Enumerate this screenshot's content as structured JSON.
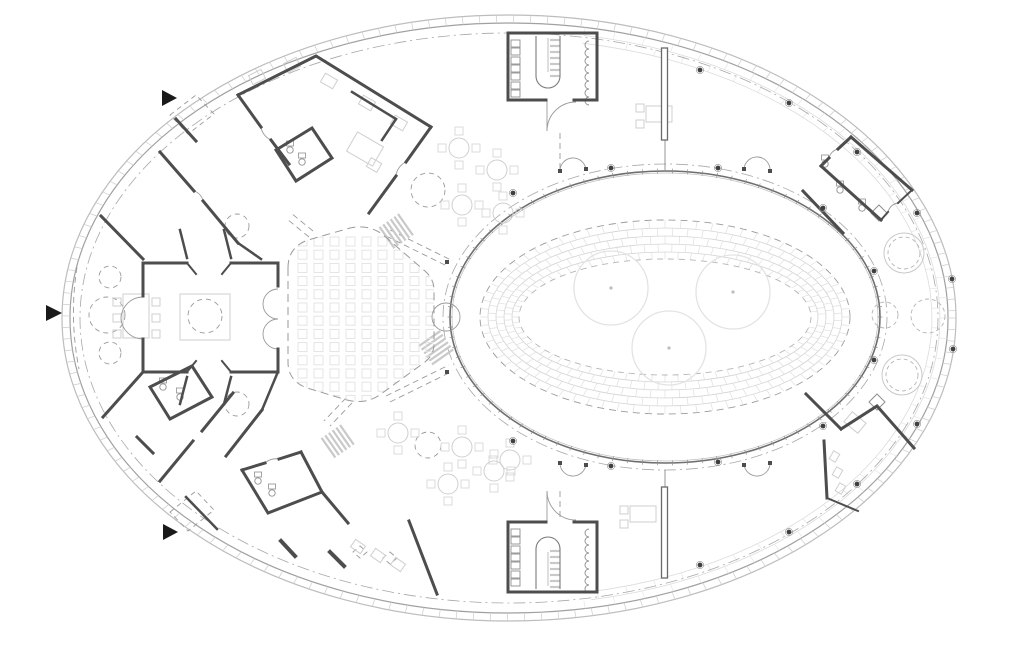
{
  "canvas": {
    "width": 1024,
    "height": 653,
    "background": "#ffffff"
  },
  "palette": {
    "wall": "#4d4d4d",
    "wallLight": "#6a6a6a",
    "medium": "#8f8f8f",
    "door": "#9a9a9a",
    "dash": "#9a9a9a",
    "light": "#cfcfcf",
    "chair": "#d8d8d8",
    "seat": "#e2e2e2",
    "faint": "#dcdcdc",
    "brick": "#d4d4d4",
    "tick": "#cccccc",
    "tree": "#e3e3e3",
    "marker": "#1a1a1a",
    "column": "#3f3f3f",
    "axis": "#a8a8a8",
    "facadeOuter": "#bdbdbd",
    "facadeInner": "#a0a0a0"
  },
  "facade": {
    "cx": 509,
    "cy": 318,
    "outer": [
      447,
      303
    ],
    "inner": [
      439,
      295
    ],
    "tickStep": 2.2,
    "axis": [
      429,
      285
    ],
    "band": {
      "courses": [
        [
          431,
          287
        ],
        [
          423,
          279
        ]
      ],
      "from": -80,
      "to": 80,
      "jointStep": 4
    }
  },
  "courtyard": {
    "cx": 665,
    "cy": 317,
    "glass": [
      215,
      146
    ],
    "glassInner": [
      213,
      144
    ],
    "axis": [
      222,
      153
    ],
    "mullionStep": 4,
    "dashedOuter": [
      185,
      97
    ],
    "brickOuter": [
      185,
      97
    ],
    "brickInner": [
      146,
      58
    ],
    "brickCourses": [
      [
        177,
        89
      ],
      [
        169,
        81
      ],
      [
        161,
        73
      ],
      [
        153,
        65
      ]
    ],
    "jointStep": 5,
    "dashedInner": [
      146,
      58
    ],
    "trees": [
      [
        611,
        288,
        37
      ],
      [
        733,
        292,
        37
      ],
      [
        669,
        348,
        37
      ]
    ]
  },
  "auditorium": {
    "outline": "M288,268 L288,362 Q288,381 307,388 L347,400 Q366,405 381,394 L425,362 Q434,355 434,344 L434,290 Q434,279 425,271 L382,234 Q368,224 350,228 L308,240 Q288,247 288,268 Z",
    "seats": {
      "x0": 298,
      "y0": 237,
      "cols": 9,
      "rows": 13,
      "dx": 16,
      "dy": 13.2,
      "size": 9
    }
  },
  "walls": [
    {
      "d": "M508,100 L508,33 L597,33 L597,100",
      "w": 3
    },
    {
      "d": "M508,100 L546,100",
      "w": 3
    },
    {
      "d": "M574,100 L597,100",
      "w": 3
    },
    {
      "d": "M508,522 L508,592 L597,592 L597,522",
      "w": 3
    },
    {
      "d": "M508,522 L546,522",
      "w": 3
    },
    {
      "d": "M574,522 L597,522",
      "w": 3
    },
    {
      "d": "M143,263 L187,263",
      "w": 3
    },
    {
      "d": "M231,263 L278,263",
      "w": 3
    },
    {
      "d": "M143,372 L187,372",
      "w": 3
    },
    {
      "d": "M231,372 L278,372",
      "w": 3
    },
    {
      "d": "M143,263 L143,296",
      "w": 3
    },
    {
      "d": "M143,339 L143,372",
      "w": 3
    },
    {
      "d": "M278,263 L278,286",
      "w": 3
    },
    {
      "d": "M278,349 L278,372",
      "w": 3
    },
    {
      "d": "M187,263 L196,274",
      "w": 2
    },
    {
      "d": "M231,263 L222,274",
      "w": 2
    },
    {
      "d": "M187,372 L196,361",
      "w": 2
    },
    {
      "d": "M231,372 L222,361",
      "w": 2
    },
    {
      "d": "M187,258 L180,230",
      "w": 2.5
    },
    {
      "d": "M231,258 L224,230",
      "w": 2.5
    },
    {
      "d": "M187,377 L180,404",
      "w": 2.5
    },
    {
      "d": "M231,377 L224,404",
      "w": 2.5
    },
    {
      "d": "M238,95 L316,56 L431,127",
      "w": 3
    },
    {
      "d": "M431,127 L406,162",
      "w": 3
    },
    {
      "d": "M396,176 L369,213",
      "w": 3
    },
    {
      "d": "M238,95 L261,127",
      "w": 3
    },
    {
      "d": "M271,140 L289,164",
      "w": 3
    },
    {
      "d": "M276,150 L312,128 L332,158 L296,181 Z",
      "w": 3
    },
    {
      "d": "M160,152 L194,191",
      "w": 3
    },
    {
      "d": "M203,201 L238,243",
      "w": 3
    },
    {
      "d": "M238,243 L261,259",
      "w": 2.5
    },
    {
      "d": "M143,259 L101,216",
      "w": 3
    },
    {
      "d": "M176,119 L196,141",
      "w": 3
    },
    {
      "d": "M352,92 L396,119",
      "w": 2.5
    },
    {
      "d": "M396,119 L382,140",
      "w": 2.5
    },
    {
      "d": "M143,372 L103,417",
      "w": 3
    },
    {
      "d": "M160,481 L193,441",
      "w": 3
    },
    {
      "d": "M202,431 L233,393",
      "w": 3
    },
    {
      "d": "M150,387 L192,366 L212,397 L170,419 Z",
      "w": 3
    },
    {
      "d": "M226,456 L262,410",
      "w": 3
    },
    {
      "d": "M262,410 L277,374",
      "w": 2.5
    },
    {
      "d": "M242,470 L265,463",
      "w": 3
    },
    {
      "d": "M279,459 L301,452",
      "w": 3
    },
    {
      "d": "M301,452 L322,492 L268,513 L242,470",
      "w": 3
    },
    {
      "d": "M322,492 L348,523",
      "w": 3
    },
    {
      "d": "M137,437 L153,453",
      "w": 3
    },
    {
      "d": "M186,497 L217,529",
      "w": 2.5
    },
    {
      "d": "M409,521 L437,594",
      "w": 3
    },
    {
      "d": "M281,541 L295,556",
      "w": 4
    },
    {
      "d": "M330,552 L344,566",
      "w": 4
    },
    {
      "d": "M851,137 L912,190",
      "w": 3
    },
    {
      "d": "M821,166 L881,220",
      "w": 3
    },
    {
      "d": "M803,191 L843,233",
      "w": 3
    },
    {
      "d": "M851,137 L838,149",
      "w": 3
    },
    {
      "d": "M829,158 L821,166",
      "w": 3
    },
    {
      "d": "M912,190 L898,203",
      "w": 2
    },
    {
      "d": "M888,212 L881,220",
      "w": 2
    },
    {
      "d": "M806,394 L841,429",
      "w": 3
    },
    {
      "d": "M841,429 L877,406 L914,448",
      "w": 3
    },
    {
      "d": "M824,441 L827,498",
      "w": 3
    },
    {
      "d": "M827,498 L858,511",
      "w": 2
    }
  ],
  "freeWalls": [
    {
      "x": 661.5,
      "y": 48,
      "w": 6,
      "h": 92
    },
    {
      "x": 661.5,
      "y": 487,
      "w": 6,
      "h": 91
    }
  ],
  "mediumPaths": [
    {
      "d": "M536,36 L536,76 A12,12 0 0 0 560,76 L560,36",
      "w": 1.1
    },
    {
      "d": "M536,589 L536,549 A12,12 0 0 1 560,549 L560,589",
      "w": 1.1
    },
    {
      "d": "M665,140 L665,170",
      "w": 0.8
    },
    {
      "d": "M665,470 L665,487",
      "w": 0.8
    },
    {
      "d": "M663.5,118 L663.5,138",
      "w": 0.5
    },
    {
      "d": "M666.5,118 L666.5,138",
      "w": 0.5
    },
    {
      "d": "M548,38 L548,72",
      "w": 0.5
    },
    {
      "d": "M548,586 L548,552",
      "w": 0.5
    }
  ],
  "mediumPolys": [
    "M879,205 L887,213 L879,221 L871,213 Z",
    "M877,394 L885,402 L877,410 L869,402 Z"
  ],
  "lockers": [
    [
      511,
      40,
      9,
      7
    ],
    [
      511,
      48,
      9,
      7
    ],
    [
      511,
      57,
      9,
      7
    ],
    [
      511,
      65,
      9,
      7
    ],
    [
      511,
      73,
      9,
      7
    ],
    [
      511,
      82,
      9,
      7
    ],
    [
      511,
      90,
      9,
      7
    ],
    [
      511,
      529,
      9,
      7
    ],
    [
      511,
      537,
      9,
      7
    ],
    [
      511,
      546,
      9,
      7
    ],
    [
      511,
      554,
      9,
      7
    ],
    [
      511,
      562,
      9,
      7
    ],
    [
      511,
      571,
      9,
      7
    ],
    [
      511,
      579,
      9,
      7
    ]
  ],
  "hooks": [
    {
      "x": 589,
      "y0": 41,
      "n": 8,
      "gap": 8,
      "r": 4
    },
    {
      "x": 589,
      "y0": 529,
      "n": 8,
      "gap": 8,
      "r": 4
    }
  ],
  "doorArcs": [
    "M547,131 A29,29 0 0 1 576,102",
    "M547,101 L547,131",
    "M547,491 A29,29 0 0 0 576,520",
    "M547,521 L547,491",
    "M143,297 A22,22 0 0 0 121,318",
    "M143,339 A22,22 0 0 1 121,318",
    "M278,289 A15,15 0 0 0 278,319",
    "M278,319 A15,15 0 0 0 278,349",
    "M446,303 A14,14 0 0 1 446,331",
    "M446,303 A14,14 0 0 0 446,331",
    "M560,172 A13,13 0 0 1 586,170",
    "M744,169 A13,13 0 0 1 770,171",
    "M560,462 A13,13 0 0 0 586,464",
    "M744,464 A13,13 0 0 0 770,462",
    "M261,127 A17,17 0 0 0 271,140",
    "M194,191 A13,13 0 0 1 203,201",
    "M406,162 A17,17 0 0 0 396,176",
    "M265,463 A17,17 0 0 1 279,459",
    "M838,149 A12,12 0 0 0 829,158",
    "M898,203 A12,12 0 0 0 888,212"
  ],
  "posts": [
    [
      560,
      171
    ],
    [
      586,
      169
    ],
    [
      744,
      169
    ],
    [
      770,
      171
    ],
    [
      560,
      463
    ],
    [
      586,
      465
    ],
    [
      744,
      465
    ],
    [
      770,
      463
    ],
    [
      447,
      262
    ],
    [
      447,
      372
    ]
  ],
  "hatches": [
    {
      "x": 398,
      "y": 214,
      "n": 6,
      "gap": 4.5,
      "len": 26,
      "ang": 55
    },
    {
      "x": 419,
      "y": 346,
      "n": 6,
      "gap": 4.5,
      "len": 26,
      "ang": -35
    },
    {
      "x": 340,
      "y": 425,
      "n": 6,
      "gap": 4.5,
      "len": 24,
      "ang": 55
    },
    {
      "x": 550,
      "y": 40,
      "n": 7,
      "gap": 6,
      "len": 10,
      "ang": 0
    },
    {
      "x": 550,
      "y": 551,
      "n": 7,
      "gap": 6,
      "len": 10,
      "ang": 0
    }
  ],
  "dashed": {
    "circles": [
      [
        107,
        315,
        18
      ],
      [
        110,
        277,
        11
      ],
      [
        110,
        353,
        11
      ],
      [
        237,
        226,
        12
      ],
      [
        237,
        404,
        12
      ],
      [
        205,
        316,
        17
      ],
      [
        428,
        190,
        17
      ],
      [
        428,
        445,
        13
      ]
    ],
    "polygons": [
      "M170,115 L196,95 L214,114 L188,134 Z",
      "M170,512 L196,491 L214,510 L188,531 Z",
      "M360,546 L367,552 L360,558 L353,552 Z",
      "M390,552 L397,558 L390,564 L383,558 Z"
    ],
    "lines": [
      "M386,236 L449,267",
      "M390,230 L453,261",
      "M386,396 L449,365",
      "M390,402 L453,371",
      "M346,398 L324,421",
      "M352,403 L330,426",
      "M560,133 L560,170",
      "M560,491 L560,520",
      "M313,231 L291,213",
      "M309,237 L287,219",
      "M77,267 Q69,318 79,369"
    ]
  },
  "furniture": {
    "tableRadius": 10,
    "chairSize": 8,
    "chairOffsets": [
      [
        0,
        -17
      ],
      [
        17,
        0
      ],
      [
        0,
        17
      ],
      [
        -17,
        0
      ]
    ],
    "roundTables": [
      [
        459,
        148
      ],
      [
        497,
        170
      ],
      [
        462,
        205
      ],
      [
        503,
        213
      ],
      [
        398,
        433
      ],
      [
        462,
        447
      ],
      [
        510,
        460
      ],
      [
        448,
        484
      ],
      [
        494,
        471
      ]
    ],
    "rects": [
      [
        180,
        294,
        50,
        46,
        0
      ],
      [
        123,
        294,
        26,
        44,
        0
      ],
      [
        113,
        298,
        8,
        8,
        0
      ],
      [
        113,
        314,
        8,
        8,
        0
      ],
      [
        113,
        330,
        8,
        8,
        0
      ],
      [
        152,
        298,
        8,
        8,
        0
      ],
      [
        152,
        314,
        8,
        8,
        0
      ],
      [
        152,
        330,
        8,
        8,
        0
      ],
      [
        250,
        72,
        14,
        10,
        -27
      ],
      [
        285,
        60,
        14,
        10,
        -27
      ],
      [
        322,
        76,
        14,
        10,
        30
      ],
      [
        360,
        98,
        14,
        10,
        30
      ],
      [
        392,
        118,
        14,
        10,
        30
      ],
      [
        350,
        138,
        30,
        22,
        30
      ],
      [
        368,
        160,
        12,
        10,
        30
      ],
      [
        646,
        106,
        26,
        16,
        0
      ],
      [
        636,
        104,
        8,
        8,
        0
      ],
      [
        636,
        120,
        8,
        8,
        0
      ],
      [
        630,
        506,
        26,
        16,
        0
      ],
      [
        620,
        506,
        8,
        8,
        0
      ],
      [
        620,
        520,
        8,
        8,
        0
      ],
      [
        352,
        542,
        12,
        9,
        35
      ],
      [
        372,
        551,
        12,
        9,
        35
      ],
      [
        392,
        560,
        12,
        9,
        35
      ],
      [
        846,
        416,
        18,
        13,
        40
      ],
      [
        831,
        452,
        7,
        9,
        30
      ],
      [
        834,
        468,
        7,
        9,
        30
      ],
      [
        837,
        484,
        7,
        9,
        30
      ]
    ]
  },
  "planters": [
    {
      "x": 904,
      "y": 253,
      "r": 20,
      "dashOnly": false
    },
    {
      "x": 902,
      "y": 375,
      "r": 20,
      "dashOnly": false
    },
    {
      "x": 885,
      "y": 315,
      "r": 13,
      "dashOnly": true
    },
    {
      "x": 928,
      "y": 316,
      "r": 17,
      "dashOnly": true
    }
  ],
  "fixtures": [
    [
      840,
      190
    ],
    [
      862,
      208
    ],
    [
      825,
      164
    ],
    [
      163,
      387
    ],
    [
      180,
      397
    ],
    [
      258,
      481
    ],
    [
      272,
      493
    ],
    [
      290,
      150
    ],
    [
      302,
      162
    ]
  ],
  "columns": [
    [
      513,
      193
    ],
    [
      611,
      168
    ],
    [
      718,
      168
    ],
    [
      823,
      208
    ],
    [
      513,
      441
    ],
    [
      611,
      466
    ],
    [
      718,
      462
    ],
    [
      823,
      426
    ],
    [
      700,
      70
    ],
    [
      789,
      103
    ],
    [
      857,
      152
    ],
    [
      917,
      213
    ],
    [
      700,
      565
    ],
    [
      789,
      532
    ],
    [
      857,
      484
    ],
    [
      917,
      424
    ],
    [
      874,
      271
    ],
    [
      952,
      279
    ],
    [
      953,
      349
    ],
    [
      874,
      360
    ]
  ],
  "arrows": [
    [
      162,
      90,
      177,
      98,
      162,
      106
    ],
    [
      46,
      305,
      62,
      313,
      46,
      321
    ],
    [
      163,
      524,
      178,
      532,
      163,
      540
    ]
  ]
}
